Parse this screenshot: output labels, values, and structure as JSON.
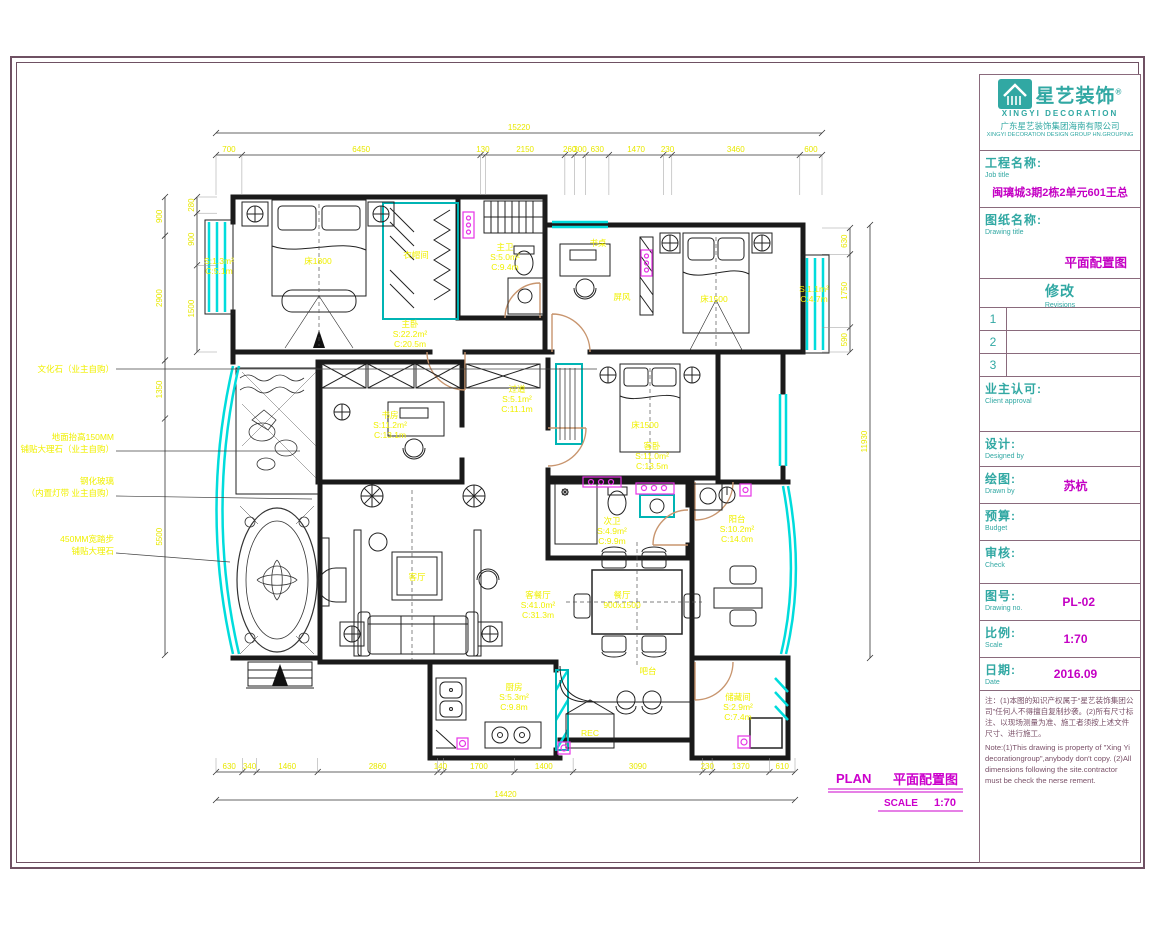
{
  "page": {
    "bg": "#ffffff",
    "frame_color": "#6f5163"
  },
  "title_block": {
    "brand": "星艺装饰",
    "brand_reg": "®",
    "brand_en": "XINGYI DECORATION",
    "company_cn": "广东星艺装饰集团海南有限公司",
    "company_en": "XINGYI DECORATION DESIGN GROUP HN.GROUPING",
    "job_label": "工程名称:",
    "job_label_en": "Job title",
    "job_value": "闽璃城3期2栋2单元601王总",
    "drawing_label": "图纸名称:",
    "drawing_label_en": "Drawing title",
    "drawing_value": "平面配置图",
    "revisions_label": "修改",
    "revisions_label_en": "Revisions",
    "revision_rows": [
      "1",
      "2",
      "3"
    ],
    "client_label": "业主认可:",
    "client_label_en": "Client approval",
    "design_label": "设计:",
    "design_label_en": "Designed by",
    "drawn_label": "绘图:",
    "drawn_label_en": "Drawn by",
    "drawn_value": "苏杭",
    "budget_label": "预算:",
    "budget_label_en": "Budget",
    "check_label": "审核:",
    "check_label_en": "Check",
    "no_label": "图号:",
    "no_label_en": "Drawing no.",
    "no_value": "PL-02",
    "scale_label": "比例:",
    "scale_label_en": "Scale",
    "scale_value": "1:70",
    "date_label": "日期:",
    "date_label_en": "Date",
    "date_value": "2016.09",
    "note_cn": "注：(1)本图的知识产权属于“星艺装饰集团公司”任何人不得擅自复制抄袭。(2)所有尺寸标注、以现场测量为准、施工者须按上述文件尺寸、进行施工。",
    "note_en": "Note:(1)This drawing is property of \"Xing Yi decorationgroup\",anybody don't copy.  (2)All dimensions following the site.contractor must be check the nerse rement."
  },
  "plan": {
    "title": "PLAN",
    "title_cn": "平面配置图",
    "scale_label": "SCALE",
    "scale_value": "1:70",
    "labels": [
      {
        "n": "room-label-master-bedroom",
        "x": 410,
        "y": 327,
        "lines": [
          "主卧",
          "S:22.2m²",
          "C:20.5m"
        ]
      },
      {
        "n": "room-label-closet",
        "x": 416,
        "y": 258,
        "lines": [
          "衣帽间"
        ]
      },
      {
        "n": "room-label-master-bath",
        "x": 505,
        "y": 250,
        "lines": [
          "主卫",
          "S:5.0m²",
          "C:9.4m"
        ]
      },
      {
        "n": "furniture-label-bed-1800",
        "x": 318,
        "y": 264,
        "lines": [
          "床1800"
        ]
      },
      {
        "n": "furniture-label-desk",
        "x": 598,
        "y": 246,
        "lines": [
          "书桌"
        ]
      },
      {
        "n": "furniture-label-screen",
        "x": 622,
        "y": 300,
        "lines": [
          "屏风"
        ]
      },
      {
        "n": "furniture-label-bed-1500-study",
        "x": 714,
        "y": 302,
        "lines": [
          "床1500"
        ]
      },
      {
        "n": "area-label-bay-window-right",
        "x": 814,
        "y": 292,
        "lines": [
          "S:1.1m²",
          "C:4.7m"
        ]
      },
      {
        "n": "area-label-bay-window-left",
        "x": 219,
        "y": 264,
        "lines": [
          "S:1.3m²",
          "C:5.1m"
        ]
      },
      {
        "n": "room-label-study",
        "x": 390,
        "y": 418,
        "lines": [
          "书房",
          "S:11.2m²",
          "C:13.1m"
        ]
      },
      {
        "n": "room-label-corridor",
        "x": 517,
        "y": 392,
        "lines": [
          "过道",
          "S:5.1m²",
          "C:11.1m"
        ]
      },
      {
        "n": "furniture-label-bed-1500-guest",
        "x": 645,
        "y": 428,
        "lines": [
          "床1500"
        ]
      },
      {
        "n": "room-label-guest-bedroom",
        "x": 652,
        "y": 449,
        "lines": [
          "客卧",
          "S:11.0m²",
          "C:13.5m"
        ]
      },
      {
        "n": "room-label-second-bath",
        "x": 612,
        "y": 524,
        "lines": [
          "次卫",
          "S:4.9m²",
          "C:9.9m"
        ]
      },
      {
        "n": "room-label-balcony",
        "x": 737,
        "y": 522,
        "lines": [
          "阳台",
          "S:10.2m²",
          "C:14.0m"
        ]
      },
      {
        "n": "room-label-living-dining",
        "x": 538,
        "y": 598,
        "lines": [
          "客餐厅",
          "S:41.0m²",
          "C:31.3m"
        ]
      },
      {
        "n": "furniture-label-living-table",
        "x": 417,
        "y": 580,
        "lines": [
          "客厅"
        ]
      },
      {
        "n": "furniture-label-dining-table",
        "x": 622,
        "y": 598,
        "lines": [
          "餐厅",
          "900x1500"
        ]
      },
      {
        "n": "furniture-label-bar",
        "x": 648,
        "y": 674,
        "lines": [
          "吧台"
        ]
      },
      {
        "n": "furniture-label-fridge",
        "x": 590,
        "y": 736,
        "lines": [
          "REC"
        ]
      },
      {
        "n": "room-label-kitchen",
        "x": 514,
        "y": 690,
        "lines": [
          "厨房",
          "S:5.3m²",
          "C:9.8m"
        ]
      },
      {
        "n": "room-label-storage",
        "x": 738,
        "y": 700,
        "lines": [
          "储藏间",
          "S:2.9m²",
          "C:7.4m"
        ]
      }
    ],
    "annotations": [
      {
        "n": "annotation-culture-stone",
        "tx": 114,
        "ty": 372,
        "lines": [
          "文化石（业主自购）"
        ],
        "leader": [
          116,
          369,
          597,
          369
        ]
      },
      {
        "n": "annotation-floor-marble",
        "tx": 114,
        "ty": 440,
        "lines": [
          "地面抬高150MM",
          "铺贴大理石（业主自购）"
        ],
        "leader": [
          116,
          451,
          300,
          451
        ]
      },
      {
        "n": "annotation-tempered-glass",
        "tx": 114,
        "ty": 484,
        "lines": [
          "钢化玻璃",
          "（内置灯带 业主自购）"
        ],
        "leader": [
          116,
          496,
          312,
          499
        ]
      },
      {
        "n": "annotation-step",
        "tx": 114,
        "ty": 542,
        "lines": [
          "450MM宽踏步",
          "铺贴大理石"
        ],
        "leader": [
          116,
          553,
          230,
          562
        ]
      }
    ]
  },
  "dimensions": {
    "chains": [
      {
        "n": "dim-top-overall",
        "x1": 216,
        "y1": 133,
        "x2": 822,
        "y2": 133,
        "values": [
          "15220"
        ],
        "ext": 0
      },
      {
        "n": "dim-top-segments",
        "x1": 216,
        "y1": 155,
        "x2": 822,
        "y2": 155,
        "values": [
          "700",
          "6450",
          "130",
          "2150",
          "260",
          "300",
          "630",
          "1470",
          "230",
          "3460",
          "600"
        ],
        "ext": 40
      },
      {
        "n": "dim-bottom-segments",
        "x1": 216,
        "y1": 772,
        "x2": 795,
        "y2": 772,
        "values": [
          "630",
          "340",
          "1460",
          "2860",
          "140",
          "1700",
          "1400",
          "3090",
          "230",
          "1370",
          "610"
        ],
        "ext": -14
      },
      {
        "n": "dim-bottom-overall",
        "x1": 216,
        "y1": 800,
        "x2": 795,
        "y2": 800,
        "values": [
          "14420"
        ],
        "ext": 0
      },
      {
        "n": "dim-left-inner",
        "x1": 197,
        "y1": 197,
        "x2": 197,
        "y2": 352,
        "values": [
          "280",
          "900",
          "1500"
        ],
        "ext": 20
      },
      {
        "n": "dim-left-outer",
        "x1": 165,
        "y1": 197,
        "x2": 165,
        "y2": 655,
        "values": [
          "900",
          "2900",
          "1350",
          "5500"
        ],
        "ext": 0
      },
      {
        "n": "dim-right-inner",
        "x1": 850,
        "y1": 228,
        "x2": 850,
        "y2": 352,
        "values": [
          "630",
          "1750",
          "590"
        ],
        "ext": -28
      },
      {
        "n": "dim-right-overall",
        "x1": 870,
        "y1": 225,
        "x2": 870,
        "y2": 658,
        "values": [
          "11930"
        ],
        "ext": 0
      }
    ]
  },
  "colors": {
    "wall": "#1a1a1a",
    "window": "#00dcdc",
    "door": "#c8956e",
    "label_yellow": "#f0f000",
    "magenta": "#cc00cc",
    "teal": "#31a8a3",
    "frame": "#6f5163"
  }
}
